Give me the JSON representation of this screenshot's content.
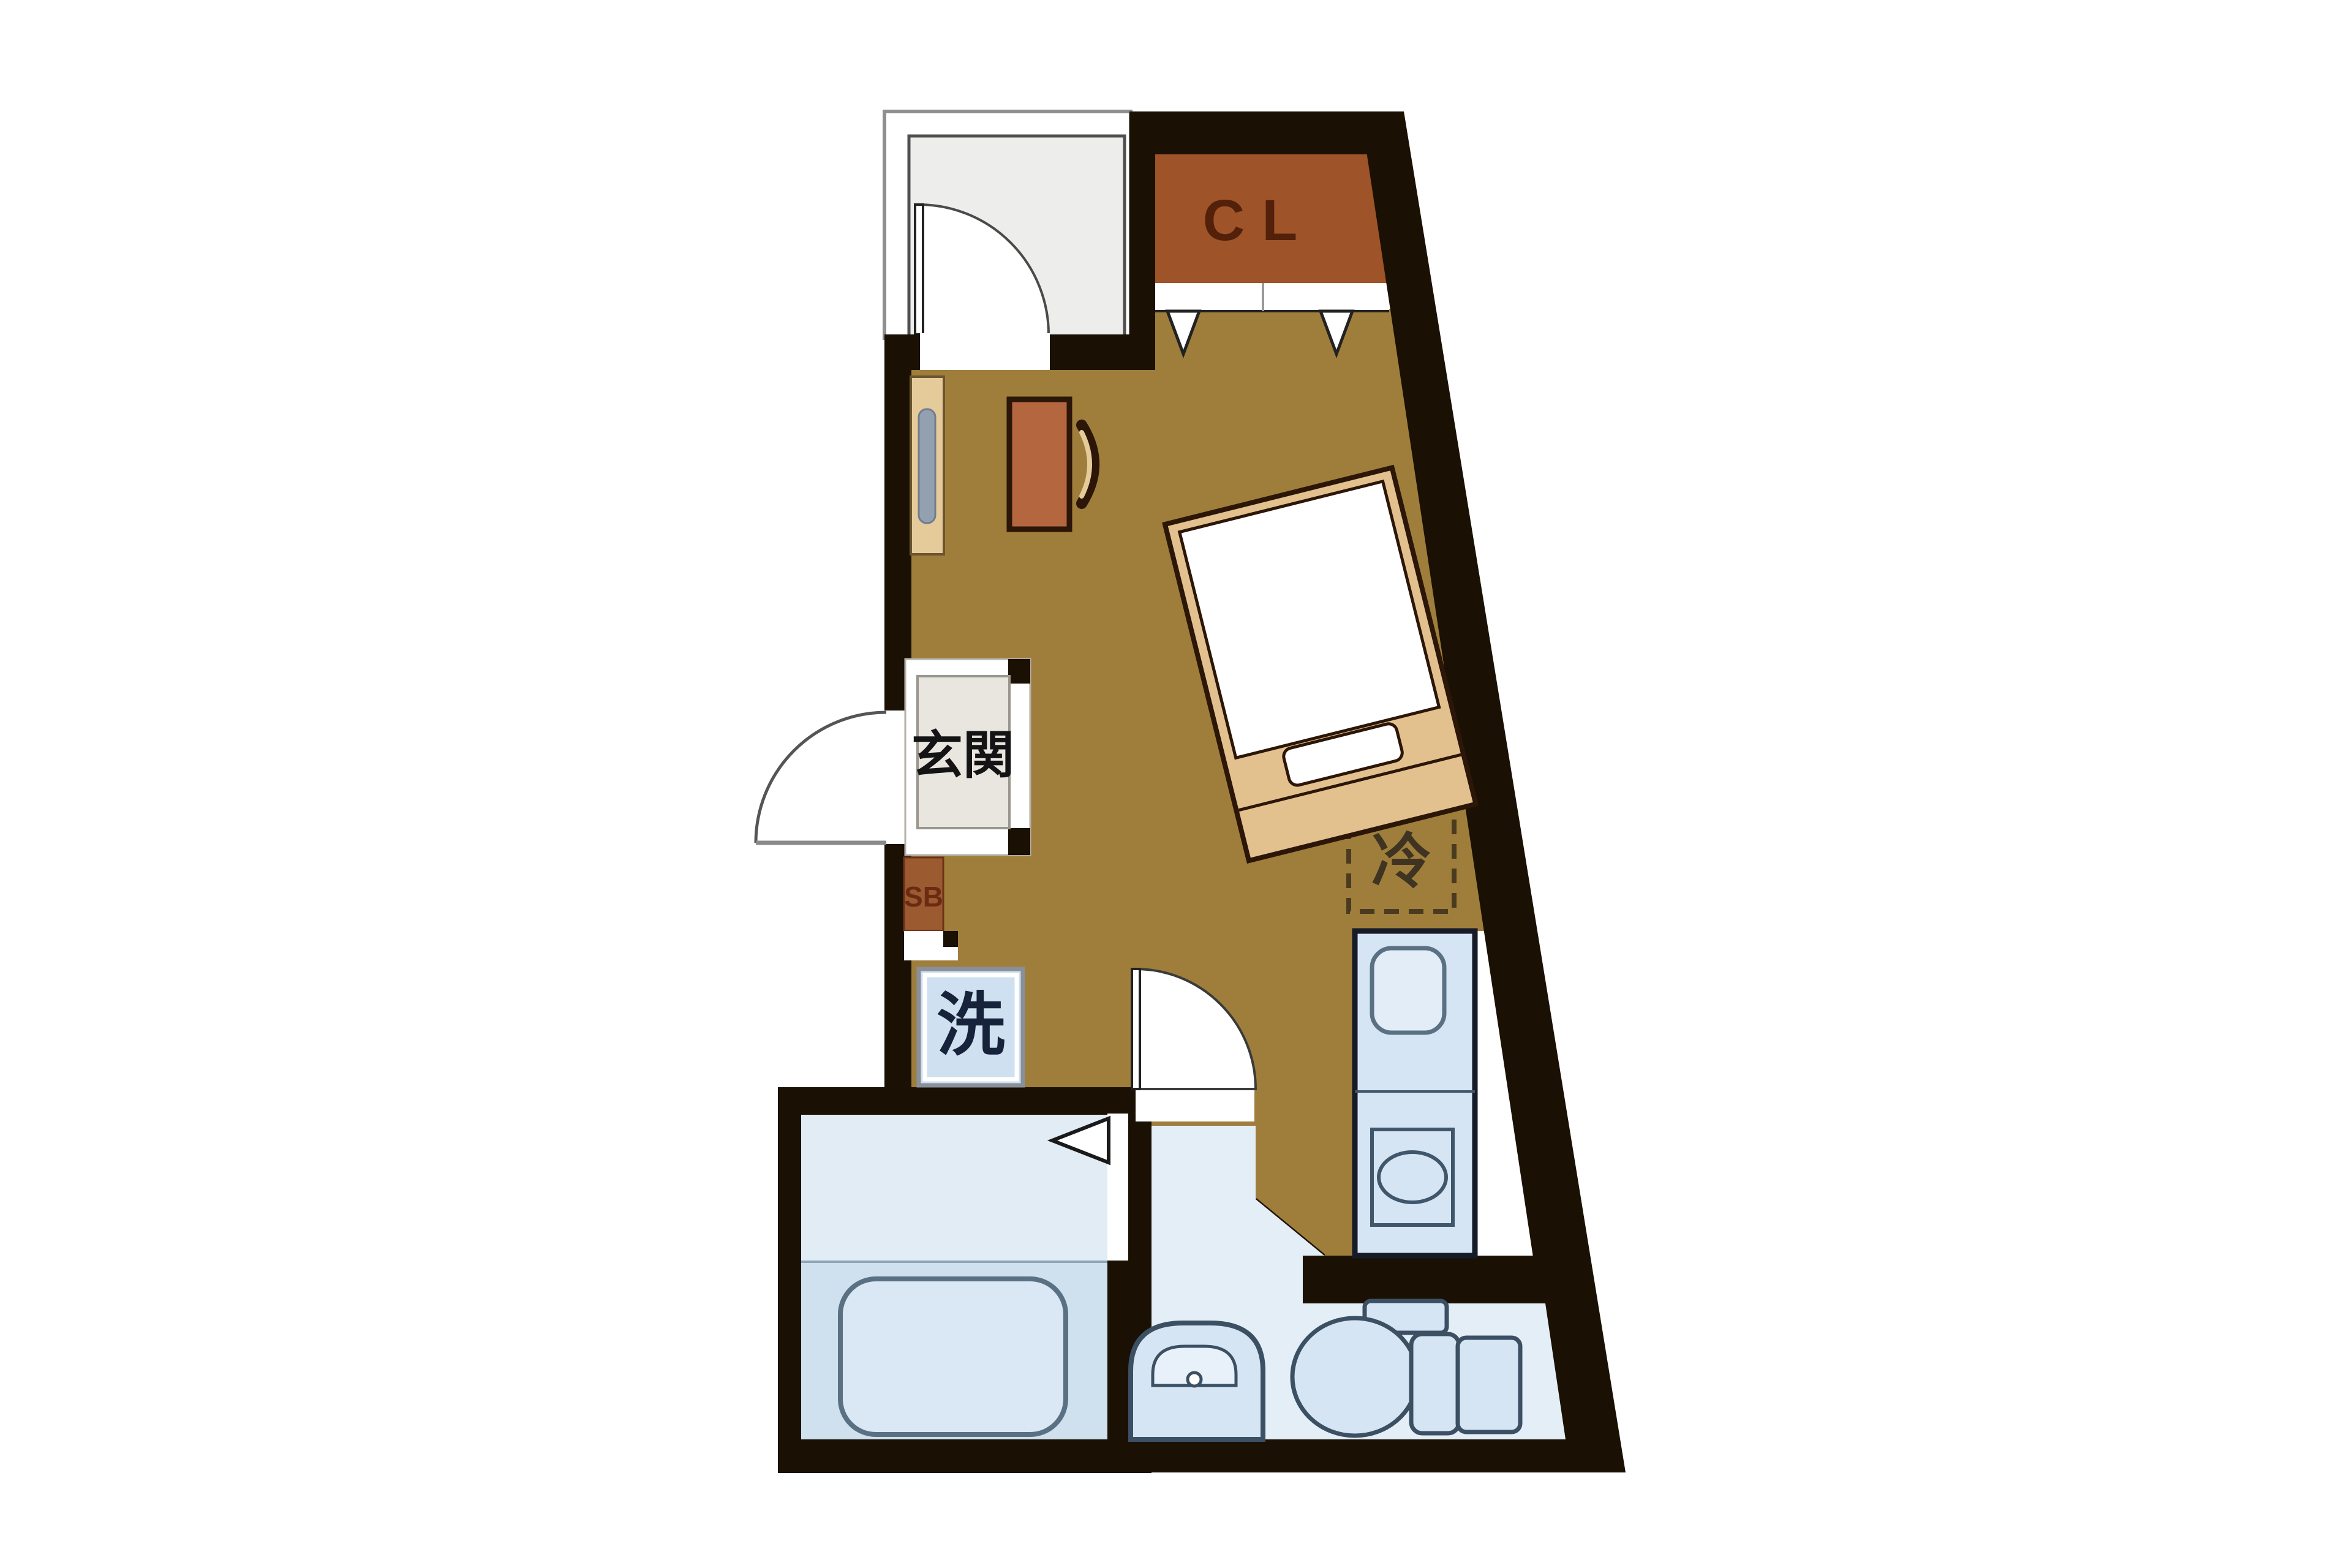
{
  "image": {
    "type": "floor-plan",
    "description": "Japanese studio apartment floor plan (madori), irregular trapezoid unit with slanted right wall"
  },
  "labels": {
    "closet": "CL",
    "entrance": "玄関",
    "shoe_cabinet": "SB",
    "washing_machine": "洗",
    "refrigerator": "冷"
  },
  "colors": {
    "wall": "#1a1003",
    "flooring": "#9f7e3b",
    "closet_fill": "#9e5328",
    "closet_text": "#53200a",
    "wood_light": "#e3c18f",
    "desk": "#b4673e",
    "fixture_fill": "#d6e5f3",
    "fixture_stroke": "#3c5064",
    "bath_floor_upper": "#e2ecf5",
    "bath_floor_lower": "#cfe0ef",
    "washroom_floor": "#e4eef7",
    "gray_room_fill": "#ededec",
    "entrance_fill": "#e9e6e0",
    "washer_fill": "#cfe0f0",
    "label_dark": "#16233a"
  },
  "fixtures": [
    "closet",
    "folding-closet-door",
    "gray-room",
    "room-door-swing",
    "bed",
    "pillow",
    "desk",
    "chair",
    "wall-shelf",
    "refrigerator",
    "kitchen-unit",
    "kitchen-sink",
    "stove-burner",
    "entrance-hall",
    "entrance-door-swing",
    "shoe-cabinet",
    "washing-machine",
    "bathroom",
    "bathtub",
    "bathroom-folding-door",
    "washroom",
    "washbasin",
    "toilet"
  ]
}
